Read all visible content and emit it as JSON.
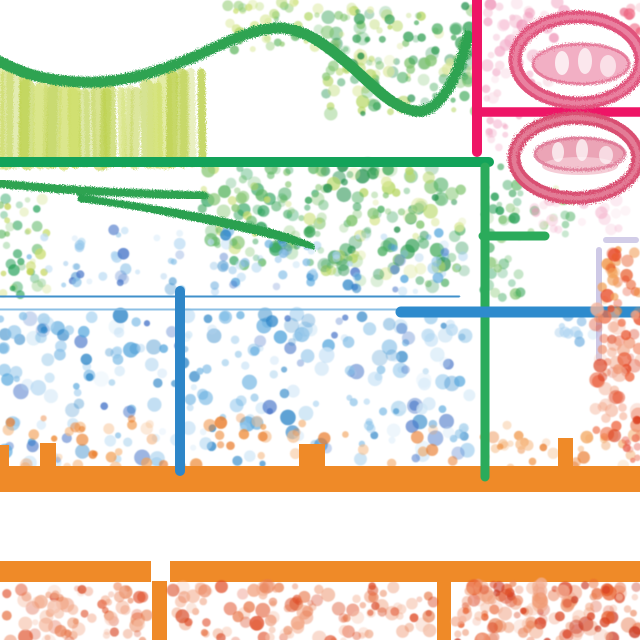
{
  "artwork": {
    "canvas": {
      "width": 640,
      "height": 640,
      "background": "#ffffff"
    },
    "palette": {
      "green_stroke": "#2da351",
      "green_line": "#13a35a",
      "green_vertical": "#2bab5b",
      "olive": "#c5d65c",
      "magenta": "#ee1566",
      "oval_ring_1": "#e0527b",
      "oval_ring_2": "#d94f72",
      "oval_fill": "#f2afc4",
      "purple": "#8179b8",
      "blue_crayon": "#4190cb",
      "blue_light": "#7fb9e2",
      "blue_solid": "#2e8bcd",
      "orange": "#ef8a28"
    },
    "layers": [
      {
        "id": "olive-hatch-block",
        "type": "texture",
        "x0": 2,
        "x1": 200,
        "anchors": [
          [
            0,
            68
          ],
          [
            45,
            84
          ],
          [
            100,
            88
          ],
          [
            150,
            82
          ],
          [
            195,
            64
          ]
        ],
        "bottom": 160,
        "n": 30,
        "widths": [
          6,
          15
        ],
        "colors": [
          "#c5d65c",
          "#d2e070",
          "#bcd14e"
        ],
        "op": [
          0.35,
          0.85
        ],
        "seed": 7
      },
      {
        "id": "dots-top-green-left",
        "type": "cluster",
        "x": [
          225,
          335
        ],
        "y": [
          2,
          50
        ],
        "n": 48,
        "r": [
          2.5,
          6
        ],
        "colors": [
          "#cfe37c",
          "#b5d96c",
          "#8fca6f",
          "#5db65f",
          "#d9e896"
        ],
        "seed": 11
      },
      {
        "id": "dots-top-green-right",
        "type": "cluster",
        "x": [
          326,
          476
        ],
        "y": [
          6,
          114
        ],
        "n": 150,
        "r": [
          2.5,
          7
        ],
        "colors": [
          "#2f9e52",
          "#4caf63",
          "#7fc46d",
          "#b9d868",
          "#dce89a",
          "#1f8f4a"
        ],
        "seed": 12
      },
      {
        "id": "dots-left-greens",
        "type": "cluster",
        "x": [
          0,
          48
        ],
        "y": [
          196,
          296
        ],
        "n": 42,
        "r": [
          2.5,
          6
        ],
        "colors": [
          "#1f9d52",
          "#62b968",
          "#8cc979",
          "#c8dd6e",
          "#c5d65c"
        ],
        "seed": 13
      },
      {
        "id": "dots-mid-green-right-of-line",
        "type": "cluster",
        "x": [
          202,
          326
        ],
        "y": [
          168,
          266
        ],
        "n": 100,
        "r": [
          3,
          7
        ],
        "colors": [
          "#1f9d52",
          "#36a457",
          "#62b968",
          "#8cc979",
          "#c8dd6e"
        ],
        "seed": 14
      },
      {
        "id": "dots-mid-green-big",
        "type": "cluster",
        "x": [
          322,
          470
        ],
        "y": [
          164,
          288
        ],
        "n": 120,
        "r": [
          3,
          7.5
        ],
        "colors": [
          "#2f9e52",
          "#4caf63",
          "#7fc46d",
          "#b9d868",
          "#dce89a",
          "#1f8f4a"
        ],
        "seed": 15
      },
      {
        "id": "dots-green-trail",
        "type": "cluster",
        "x": [
          483,
          522
        ],
        "y": [
          166,
          298
        ],
        "n": 45,
        "r": [
          2.5,
          6
        ],
        "colors": [
          "#1f9d52",
          "#36a457",
          "#62b968",
          "#8cc979"
        ],
        "seed": 16
      },
      {
        "id": "dots-green-trail-2",
        "type": "cluster",
        "x": [
          528,
          574
        ],
        "y": [
          186,
          238
        ],
        "n": 18,
        "r": [
          2.5,
          5.5
        ],
        "colors": [
          "#4caf63",
          "#7fc46d",
          "#b9d868"
        ],
        "op": [
          0.2,
          0.6
        ],
        "seed": 17
      },
      {
        "id": "dots-pink-top",
        "type": "cluster",
        "x": [
          486,
          568
        ],
        "y": [
          0,
          104
        ],
        "n": 60,
        "r": [
          3,
          7
        ],
        "colors": [
          "#f3aeca",
          "#f6c4d7",
          "#ee8fb4",
          "#f9d9e4"
        ],
        "seed": 18
      },
      {
        "id": "dots-pink-mid",
        "type": "cluster",
        "x": [
          487,
          524
        ],
        "y": [
          116,
          164
        ],
        "n": 13,
        "r": [
          2.5,
          5
        ],
        "colors": [
          "#f3aeca",
          "#f6c4d7",
          "#ee8fb4"
        ],
        "op": [
          0.2,
          0.55
        ],
        "seed": 19
      },
      {
        "id": "dots-pink-under-oval",
        "type": "cluster",
        "x": [
          534,
          628
        ],
        "y": [
          194,
          230
        ],
        "n": 22,
        "r": [
          3,
          6.5
        ],
        "colors": [
          "#f3aeca",
          "#f6c4d7",
          "#ee8fb4",
          "#f9d9e4"
        ],
        "op": [
          0.2,
          0.5
        ],
        "seed": 20
      },
      {
        "id": "dots-red-top-corner",
        "type": "cluster",
        "x": [
          620,
          642
        ],
        "y": [
          0,
          36
        ],
        "n": 9,
        "r": [
          3,
          6
        ],
        "colors": [
          "#e87090",
          "#ee5d7a",
          "#f4a0b5"
        ],
        "seed": 21
      },
      {
        "id": "dots-blue-sparse",
        "type": "cluster",
        "x": [
          28,
          464
        ],
        "y": [
          230,
          292
        ],
        "n": 40,
        "r": [
          2.5,
          5.5
        ],
        "colors": [
          "#9fcdee",
          "#bcdcf4",
          "#7ab4e2",
          "#57a7dd"
        ],
        "seed": 22
      },
      {
        "id": "dots-blue-columns",
        "type": "columns",
        "cols": [
          75,
          120,
          175,
          230,
          282,
          312,
          355,
          398,
          440
        ],
        "per": 8,
        "spread": 7,
        "y": [
          228,
          292
        ],
        "r": [
          3,
          6
        ],
        "colors": [
          "#2e86c8",
          "#57a7dd",
          "#85bfe7",
          "#aed5f1",
          "#4a77c9"
        ],
        "seed": 33
      },
      {
        "id": "dots-blue-field",
        "type": "cluster",
        "x": [
          0,
          472
        ],
        "y": [
          314,
          464
        ],
        "n": 260,
        "r": [
          3,
          8
        ],
        "pow": 1.25,
        "colors": [
          "#2e86c8",
          "#57a7dd",
          "#85bfe7",
          "#aed5f1",
          "#cfe6f7",
          "#4a77c9"
        ],
        "seed": 23
      },
      {
        "id": "dots-orange-mix",
        "type": "cluster",
        "x": [
          8,
          532
        ],
        "y": [
          418,
          468
        ],
        "n": 60,
        "r": [
          3,
          6.5
        ],
        "colors": [
          "#ef8b36",
          "#f2a158",
          "#e97722",
          "#f6bd8a"
        ],
        "seed": 24
      },
      {
        "id": "dots-orange-trail-right",
        "type": "cluster",
        "x": [
          478,
          642
        ],
        "y": [
          434,
          468
        ],
        "n": 30,
        "r": [
          3,
          6.5
        ],
        "colors": [
          "#ef8b36",
          "#f2a158",
          "#e97722",
          "#f6bd8a"
        ],
        "seed": 25
      },
      {
        "id": "dots-blue-near-purple",
        "type": "cluster",
        "x": [
          558,
          598
        ],
        "y": [
          314,
          342
        ],
        "n": 10,
        "r": [
          3,
          6
        ],
        "colors": [
          "#9fcdee",
          "#bcdcf4",
          "#7ab4e2"
        ],
        "seed": 26
      },
      {
        "id": "orange-bands",
        "type": "rects",
        "color": "#ef8a28",
        "items": [
          [
            0,
            466,
            642,
            26
          ],
          [
            0,
            445,
            9,
            23
          ],
          [
            40,
            443,
            16,
            25
          ],
          [
            299,
            444,
            26,
            24
          ],
          [
            558,
            438,
            15,
            30
          ],
          [
            0,
            561,
            151,
            21
          ],
          [
            170,
            561,
            472,
            21
          ],
          [
            152,
            581,
            15,
            60
          ],
          [
            437,
            581,
            14,
            60
          ]
        ]
      },
      {
        "id": "purple-bracket",
        "type": "strokes",
        "items": [
          {
            "d": "M 598 240 L 642 240",
            "color": "#8179b8",
            "w": 15,
            "chalk": true
          },
          {
            "d": "M 599 241 L 599 367",
            "color": "#8179b8",
            "w": 14,
            "chalk": true
          },
          {
            "d": "M 599 250 L 599 358",
            "color": "#a59cd1",
            "w": 6,
            "op": 0.55
          },
          {
            "d": "M 606 240 L 636 240",
            "color": "#a59cd1",
            "w": 6,
            "op": 0.5
          }
        ]
      },
      {
        "id": "line-strokes",
        "type": "strokes",
        "items": [
          {
            "d": "M -3 60 C 20 72, 40 80, 80 82 C 115 84, 152 75, 196 56 C 228 42, 250 29, 278 28 C 305 28, 326 45, 352 67 C 375 88, 394 108, 415 111 C 436 114, 452 88, 463 55 C 465 48, 467 42, 468 36",
            "color": "#2da351",
            "w": 11,
            "chalk": true
          },
          {
            "d": "M -3 183 C 50 190, 125 193, 204 196",
            "color": "#2da351",
            "w": 8.5,
            "chalk": true
          },
          {
            "d": "M 78 194 C 150 204, 212 214, 252 224 C 282 231, 302 238, 314 244 L 315 250 C 290 243, 258 235, 226 228 C 175 217, 118 206, 78 202 Z",
            "fill": "#2aa050",
            "chalk": true
          },
          {
            "d": "M 206 22 L 206 230",
            "color": "#2da04f",
            "w": 8,
            "chalk": true
          },
          {
            "d": "M 31 197 L 31 292",
            "color": "#1f9d52",
            "w": 8.5,
            "chalk": true
          },
          {
            "d": "M -3 162 L 489 162",
            "color": "#13a35a",
            "w": 10
          },
          {
            "d": "M 485 167 L 485 477",
            "color": "#2bab5b",
            "w": 9
          },
          {
            "d": "M 483 236 L 545 236",
            "color": "#2bab5b",
            "w": 9
          },
          {
            "d": "M 477 -3 L 477 152",
            "color": "#ee1566",
            "w": 10
          },
          {
            "d": "M 479 112 L 642 112",
            "color": "#ee1566",
            "w": 9.5
          },
          {
            "d": "M -3 296 L 456 297",
            "color": "#4190cb",
            "w": 8,
            "chalk": true
          },
          {
            "d": "M -3 309 L 413 310",
            "color": "#7fb9e2",
            "w": 9,
            "op": 0.9,
            "chalk": true
          },
          {
            "d": "M 401 312 L 642 312",
            "color": "#2e8bcd",
            "w": 11
          },
          {
            "d": "M 33 292 L 33 330",
            "color": "#3d8dca",
            "w": 8,
            "chalk": true
          },
          {
            "d": "M 77 292 L 77 370",
            "color": "#3d8dca",
            "w": 8,
            "chalk": true
          },
          {
            "d": "M 135 292 L 135 342",
            "color": "#3d8dca",
            "w": 8,
            "chalk": true
          },
          {
            "d": "M 180 291 L 180 471",
            "color": "#2e86c8",
            "w": 10
          },
          {
            "d": "M 238 292 L 238 368",
            "color": "#3d8dca",
            "w": 8,
            "chalk": true
          },
          {
            "d": "M 293 292 L 293 360",
            "color": "#3d8dca",
            "w": 8,
            "chalk": true
          },
          {
            "d": "M 350 300 L 350 377",
            "color": "#3d8dca",
            "w": 7,
            "chalk": true
          },
          {
            "d": "M 420 292 L 420 373",
            "color": "#3585c5",
            "w": 9,
            "chalk": true
          }
        ]
      },
      {
        "id": "crayon-ovals",
        "type": "ellipses",
        "items": [
          {
            "cx": 578,
            "cy": 60,
            "rx": 63,
            "ry": 43,
            "stroke": "#e0527b",
            "w": 13,
            "chalk": true
          },
          {
            "cx": 578,
            "cy": 60,
            "rx": 63,
            "ry": 43,
            "stroke": "#f0a0b8",
            "w": 5,
            "op": 0.6,
            "chalk": true
          },
          {
            "cx": 581,
            "cy": 64,
            "rx": 48,
            "ry": 20,
            "fill": "#f2afc4"
          },
          {
            "cx": 581,
            "cy": 64,
            "rx": 48,
            "ry": 20,
            "stroke": "#e2688c",
            "w": 3,
            "op": 0.8,
            "chalk": true
          },
          {
            "cx": 562,
            "cy": 63,
            "rx": 7,
            "ry": 12,
            "fill": "#ffffff",
            "op": 0.75
          },
          {
            "cx": 585,
            "cy": 61,
            "rx": 7,
            "ry": 13,
            "fill": "#ffffff",
            "op": 0.7
          },
          {
            "cx": 608,
            "cy": 66,
            "rx": 8,
            "ry": 11,
            "fill": "#ffffff",
            "op": 0.6
          },
          {
            "cx": 576,
            "cy": 158,
            "rx": 62,
            "ry": 40,
            "stroke": "#d94f72",
            "w": 13,
            "chalk": true
          },
          {
            "cx": 576,
            "cy": 158,
            "rx": 62,
            "ry": 40,
            "stroke": "#eb9bae",
            "w": 5,
            "op": 0.6,
            "chalk": true
          },
          {
            "cx": 580,
            "cy": 153,
            "rx": 45,
            "ry": 16,
            "fill": "#eba4b6"
          },
          {
            "cx": 580,
            "cy": 166,
            "rx": 38,
            "ry": 9,
            "fill": "#f4c6d2",
            "op": 0.9
          },
          {
            "cx": 580,
            "cy": 154,
            "rx": 45,
            "ry": 16,
            "stroke": "#dd7090",
            "w": 3,
            "op": 0.8,
            "chalk": true
          },
          {
            "cx": 558,
            "cy": 152,
            "rx": 6,
            "ry": 10,
            "fill": "#ffffff",
            "op": 0.7
          },
          {
            "cx": 582,
            "cy": 150,
            "rx": 6,
            "ry": 11,
            "fill": "#ffffff",
            "op": 0.7
          },
          {
            "cx": 606,
            "cy": 155,
            "rx": 7,
            "ry": 9,
            "fill": "#ffffff",
            "op": 0.6
          }
        ]
      },
      {
        "id": "dots-orange-in-bracket",
        "type": "cluster",
        "x": [
          602,
          642
        ],
        "y": [
          248,
          314
        ],
        "n": 34,
        "r": [
          3.5,
          7
        ],
        "colors": [
          "#ef8b36",
          "#e8602f",
          "#f2a158",
          "#e84a28"
        ],
        "seed": 27
      },
      {
        "id": "dots-red-right",
        "type": "cluster",
        "x": [
          594,
          642
        ],
        "y": [
          306,
          436
        ],
        "n": 65,
        "r": [
          3.5,
          8
        ],
        "colors": [
          "#e8512c",
          "#d93c1e",
          "#f0906b",
          "#f4b39a",
          "#ef6a42"
        ],
        "seed": 28
      },
      {
        "id": "dots-red-edge-small",
        "type": "cluster",
        "x": [
          624,
          642
        ],
        "y": [
          438,
          470
        ],
        "n": 8,
        "r": [
          2.5,
          5
        ],
        "colors": [
          "#e85948",
          "#ee7a60"
        ],
        "seed": 29
      },
      {
        "id": "dots-bottom-block-1",
        "type": "cluster",
        "x": [
          2,
          148
        ],
        "y": [
          586,
          642
        ],
        "n": 75,
        "r": [
          3,
          7.5
        ],
        "pow": 1.15,
        "colors": [
          "#e0502b",
          "#e8764a",
          "#f2a584",
          "#d94c28",
          "#f6c3ad",
          "#ea8a60"
        ],
        "seed": 30
      },
      {
        "id": "dots-bottom-block-2",
        "type": "cluster",
        "x": [
          173,
          434
        ],
        "y": [
          586,
          642
        ],
        "n": 115,
        "r": [
          3,
          7.5
        ],
        "pow": 1.15,
        "colors": [
          "#e0502b",
          "#e8764a",
          "#f2a584",
          "#d94c28",
          "#f6c3ad",
          "#ea8a60"
        ],
        "seed": 31
      },
      {
        "id": "dots-bottom-block-3",
        "type": "cluster",
        "x": [
          455,
          642
        ],
        "y": [
          583,
          642
        ],
        "n": 140,
        "r": [
          3,
          8
        ],
        "pow": 1.1,
        "colors": [
          "#d9401f",
          "#e8602f",
          "#f09a73",
          "#c8311a",
          "#f3b096",
          "#e97f52"
        ],
        "seed": 32
      }
    ]
  }
}
